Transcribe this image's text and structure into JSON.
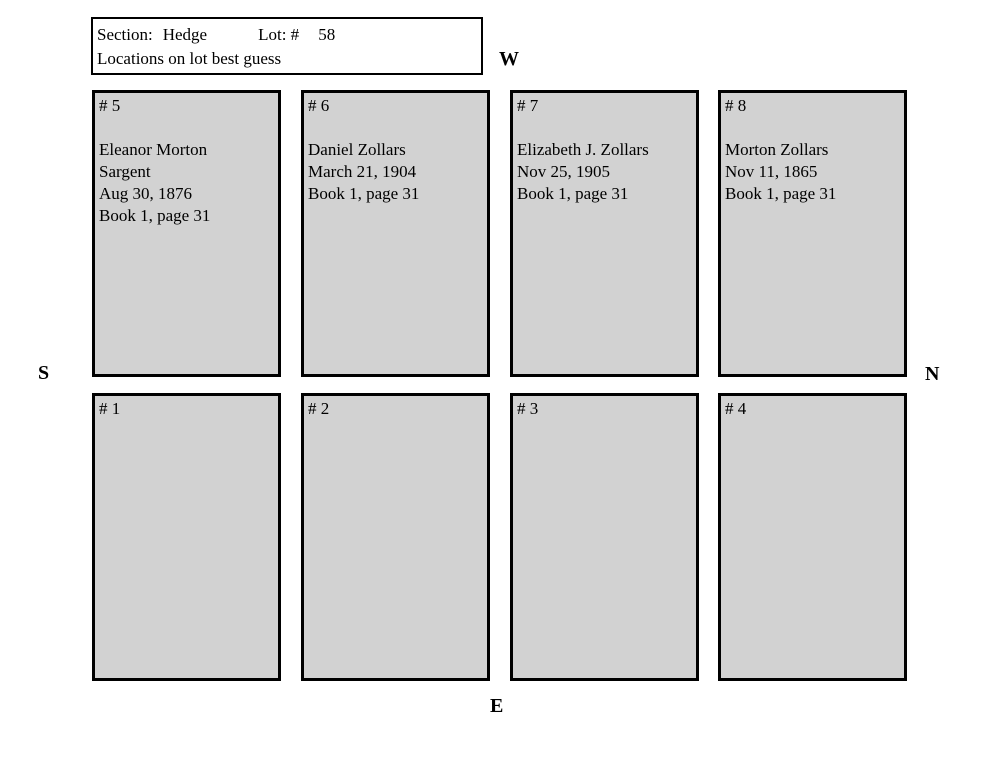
{
  "header": {
    "section_label": "Section:",
    "section_value": "Hedge",
    "lot_label": "Lot: #",
    "lot_number": "58",
    "note": "Locations on lot best guess"
  },
  "compass": {
    "west": "W",
    "south": "S",
    "north": "N",
    "east": "E"
  },
  "plots": {
    "p5": {
      "number": "# 5",
      "lines": [
        "Eleanor Morton",
        "Sargent",
        "Aug 30, 1876",
        "Book 1, page 31"
      ]
    },
    "p6": {
      "number": "# 6",
      "lines": [
        "Daniel Zollars",
        "March 21, 1904",
        "Book 1, page 31"
      ]
    },
    "p7": {
      "number": "# 7",
      "lines": [
        "Elizabeth J. Zollars",
        "Nov 25, 1905",
        "Book 1, page 31"
      ]
    },
    "p8": {
      "number": "# 8",
      "lines": [
        "Morton Zollars",
        "Nov 11, 1865",
        "Book 1, page 31"
      ]
    },
    "p1": {
      "number": "# 1",
      "lines": []
    },
    "p2": {
      "number": "# 2",
      "lines": []
    },
    "p3": {
      "number": "# 3",
      "lines": []
    },
    "p4": {
      "number": "# 4",
      "lines": []
    }
  },
  "colors": {
    "plot_fill": "#d2d2d2",
    "border": "#000000",
    "background": "#ffffff",
    "text": "#000000"
  }
}
